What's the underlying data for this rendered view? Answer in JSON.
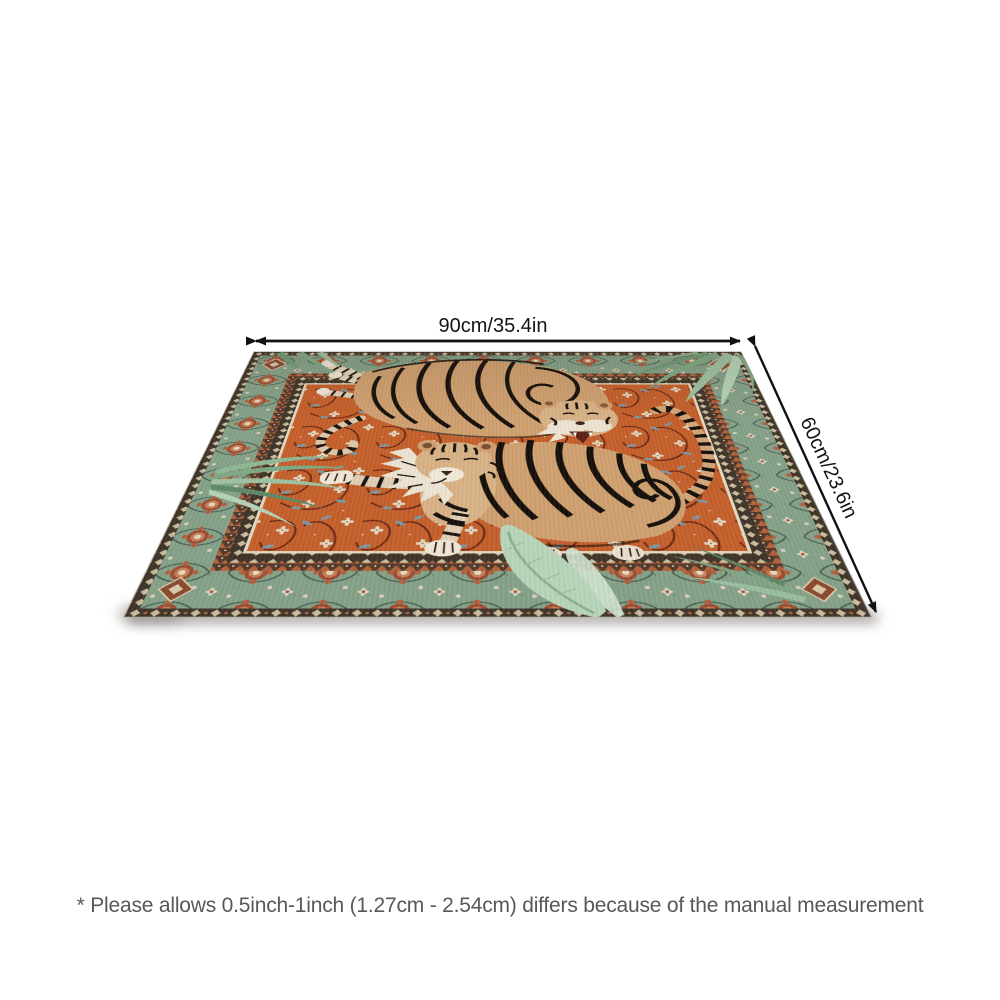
{
  "annotations": {
    "width_label": "90cm/35.4in",
    "height_label": "60cm/23.6in",
    "disclaimer": "* Please allows 0.5inch-1inch (1.27cm - 2.54cm) differs because of the manual measurement"
  },
  "icons": {
    "width_arrow": "double-headed-arrow",
    "height_arrow": "double-headed-arrow"
  },
  "product_image": {
    "subject": "tiger jungle persian-style area rug shown in perspective",
    "motifs": [
      "two tigers",
      "palm leaves",
      "floral vine field",
      "floral border"
    ],
    "colors": {
      "field_orange": "#c4602c",
      "border_sage_green": "#85a188",
      "trim_dark_brown": "#3f352a",
      "rosette_rust": "#9e4e32",
      "flower_cream": "#e9e1d0",
      "sprig_blue": "#7d98a2",
      "tiger_tan": "#cfa070",
      "tiger_cream": "#ece3d2",
      "stripe_black": "#17110c",
      "leaf_green": "#7fa985",
      "arrow_black": "#111111",
      "disclaimer_gray": "#585858",
      "background": "#ffffff"
    }
  }
}
